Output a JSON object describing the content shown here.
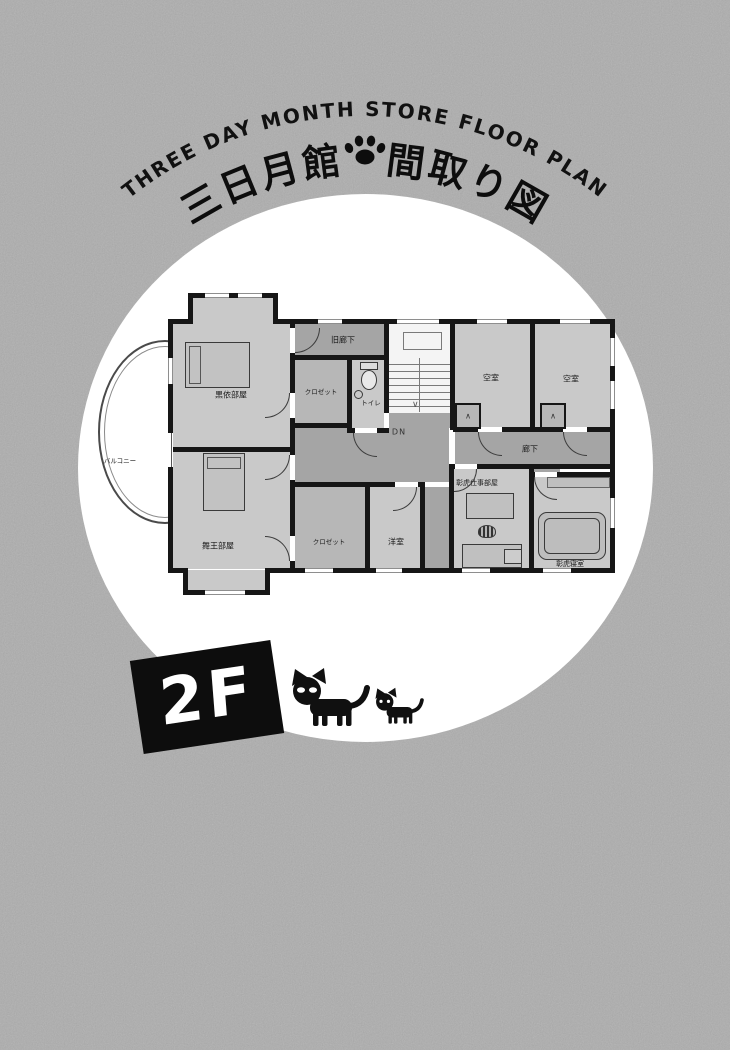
{
  "colors": {
    "background": "#ADADAD",
    "circle": "#FFFFFF",
    "room_fill": "#C9C9C9",
    "corridor_fill": "#A5A5A5",
    "closet_fill": "#B7B7B7",
    "wall": "#161616",
    "badge_bg": "#0D0D0D",
    "badge_text": "#FFFFFF"
  },
  "header": {
    "title_en": "THREE DAY MONTH STORE FLOOR PLAN",
    "title_jp_left": "三日月館",
    "title_jp_right": "間取り図",
    "divider_icon": "paw-print"
  },
  "floor_badge": {
    "label": "2F"
  },
  "floorplan": {
    "rooms": {
      "kuroi_room": "黒依部屋",
      "mao_room": "舞王部屋",
      "balcony": "バルコニー",
      "old_corridor": "旧廊下",
      "closet_upper": "クロゼット",
      "toilet": "トイレ",
      "stairs_down": "DN",
      "vacant_room_1": "空室",
      "vacant_room_2": "空室",
      "hallway": "廊下",
      "akitora_workroom": "彰虎仕事部屋",
      "akitora_bedroom": "彰虎寝室",
      "closet_lower": "クロゼット",
      "western_room": "洋室"
    }
  },
  "decorations": {
    "cats": [
      "black-cat-large",
      "black-cat-small"
    ]
  }
}
